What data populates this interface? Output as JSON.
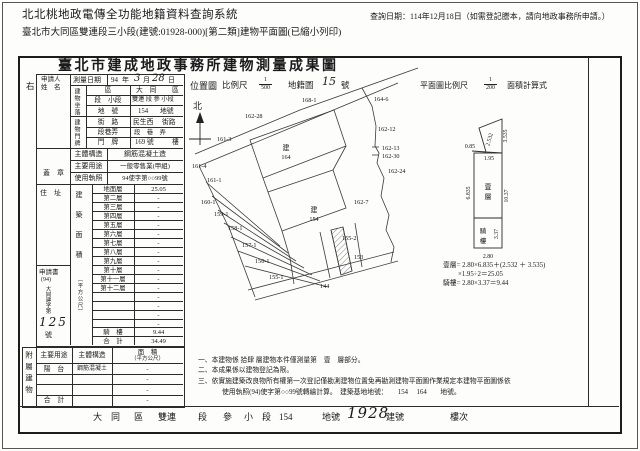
{
  "page": {
    "system_title": "北北桃地政電傳全功能地籍資料查詢系統",
    "query_date": "查詢日期：114年12月18日（如需登記謄本，請向地政事務所申請。）",
    "doc_line": "臺北市大同區雙連段三小段(建號:01928-000)[第二類]建物平面圖(已縮小列印)"
  },
  "doc": {
    "title": "臺北市建成地政事務所建物測量成果圖",
    "side_label": "右"
  },
  "applicant": {
    "name_label_1": "申請人",
    "name_label_2": "姓　名",
    "seal_label": "蓋　章",
    "address_label": "住　址",
    "application_label": "申請書",
    "application_year": "(94)",
    "application_text": "大同建字第",
    "application_number": "125",
    "application_suffix": "號"
  },
  "survey": {
    "label": "測量日期",
    "year": "94",
    "y_unit": "年",
    "month": "3",
    "m_unit": "月",
    "day": "28",
    "d_unit": "日"
  },
  "location": {
    "group": "建物坐落",
    "district_label": "區",
    "district_value": "大　同",
    "district_suffix": "區",
    "section_label": "段　小段",
    "section_value": "雙連 段 參 小段",
    "parcel_label": "地　號",
    "parcel_value": "154",
    "parcel_suffix": "地號"
  },
  "address": {
    "group": "建物門牌",
    "street_label": "街　路",
    "street_value": "民生西",
    "street_suffix": "街路",
    "lane_label": "段巷弄",
    "lane_value": "段　巷　弄",
    "door_label": "門　牌",
    "door_value": "169 號",
    "door_suffix": "樓"
  },
  "building": {
    "structure_label": "主體構造",
    "structure_value": "鋼筋混凝土造",
    "usage_label": "主要用途",
    "usage_value": "一般零售業(甲組)",
    "license_label": "使用執照",
    "license_value": "94使字第○○99號"
  },
  "floor_area": {
    "group": "建築面積",
    "unit": "（平方公尺）",
    "rows": [
      {
        "label": "地面層",
        "value": "25.05"
      },
      {
        "label": "第二層",
        "value": "-"
      },
      {
        "label": "第三層",
        "value": "-"
      },
      {
        "label": "第四層",
        "value": "-"
      },
      {
        "label": "第五層",
        "value": "-"
      },
      {
        "label": "第六層",
        "value": "-"
      },
      {
        "label": "第七層",
        "value": "-"
      },
      {
        "label": "第八層",
        "value": "-"
      },
      {
        "label": "第九層",
        "value": "-"
      },
      {
        "label": "第十層",
        "value": "-"
      },
      {
        "label": "第十一層",
        "value": "-"
      },
      {
        "label": "第十二層",
        "value": "-"
      },
      {
        "label": "",
        "value": "-"
      },
      {
        "label": "",
        "value": "-"
      },
      {
        "label": "",
        "value": "-"
      },
      {
        "label": "",
        "value": "-"
      },
      {
        "label": "騎　樓",
        "value": "9.44"
      },
      {
        "label": "合　計",
        "value": "34.49"
      }
    ]
  },
  "annex": {
    "group": "附屬建物",
    "col_usage": "主要用途",
    "col_structure": "主體構造",
    "col_area_1": "面　積",
    "col_area_2": "（平方公尺）",
    "rows": [
      {
        "usage": "陽　台",
        "structure": "鋼筋混凝土",
        "area": "-"
      },
      {
        "usage": "",
        "structure": "",
        "area": "-"
      },
      {
        "usage": "",
        "structure": "",
        "area": "-"
      },
      {
        "usage": "合　計",
        "structure": "",
        "area": "-"
      }
    ]
  },
  "site_map": {
    "title": "位置圖",
    "scale_label": "比例尺",
    "scale_num": "1",
    "scale_den": "500",
    "sheet_label": "地籍圖",
    "sheet_no": "15",
    "sheet_suffix": "號",
    "north": "北",
    "b164_prefix": "建",
    "b164": "164",
    "b154_prefix": "建",
    "b154": "154",
    "parcels": [
      "168-1",
      "164-6",
      "162-28",
      "161-3",
      "162-12",
      "162-13",
      "162-30",
      "162-24",
      "162-7",
      "161-4",
      "161-1",
      "160-1",
      "159-1",
      "158-1",
      "157-1",
      "156-1",
      "155-1",
      "155-2",
      "153",
      "144"
    ]
  },
  "plan": {
    "title": "平面圖比例尺",
    "scale_num": "1",
    "scale_den": "200",
    "calc_label": "面積計算式",
    "floor_label_1": "壹",
    "floor_label_2": "層",
    "arcade_label_1": "騎",
    "arcade_label_2": "樓",
    "dims": {
      "d085": "0.85",
      "d2532": "2.532",
      "d3535": "3.535",
      "d195": "1.95",
      "d6835": "6.835",
      "d1037": "10.37",
      "d337": "3.37",
      "d280": "2.80"
    },
    "formula1": "壹層= 2.80×6.835＋(2.532 ＋ 3.535)",
    "formula2": "×1.95÷2＝25.05",
    "formula3": "騎樓= 2.80×3.37＝9.44"
  },
  "notes": {
    "n1": "一、本建物係 拾肆 層建物本件僅測量第　壹　層部分。",
    "n2": "二、本成果係以建物登記為限。",
    "n3": "三、依實施建築改良物所有權第一次登記僅勘測建物位置免再勘測建物平面圖作業規定本建物平面圖係依",
    "n3b": "使用執照(94)使字第○○99號轉繪計算。　建築基地地號：　　154　 164　　地號。"
  },
  "footer": {
    "district": "大　同",
    "district_suffix": "區",
    "section": "雙連",
    "section_suffix": "段",
    "subsection": "參",
    "subsection_suffix": "小　段",
    "parcel": "154",
    "parcel_suffix": "地號",
    "building_no": "1928",
    "building_suffix": "建號",
    "floor_suffix": "樓次"
  }
}
